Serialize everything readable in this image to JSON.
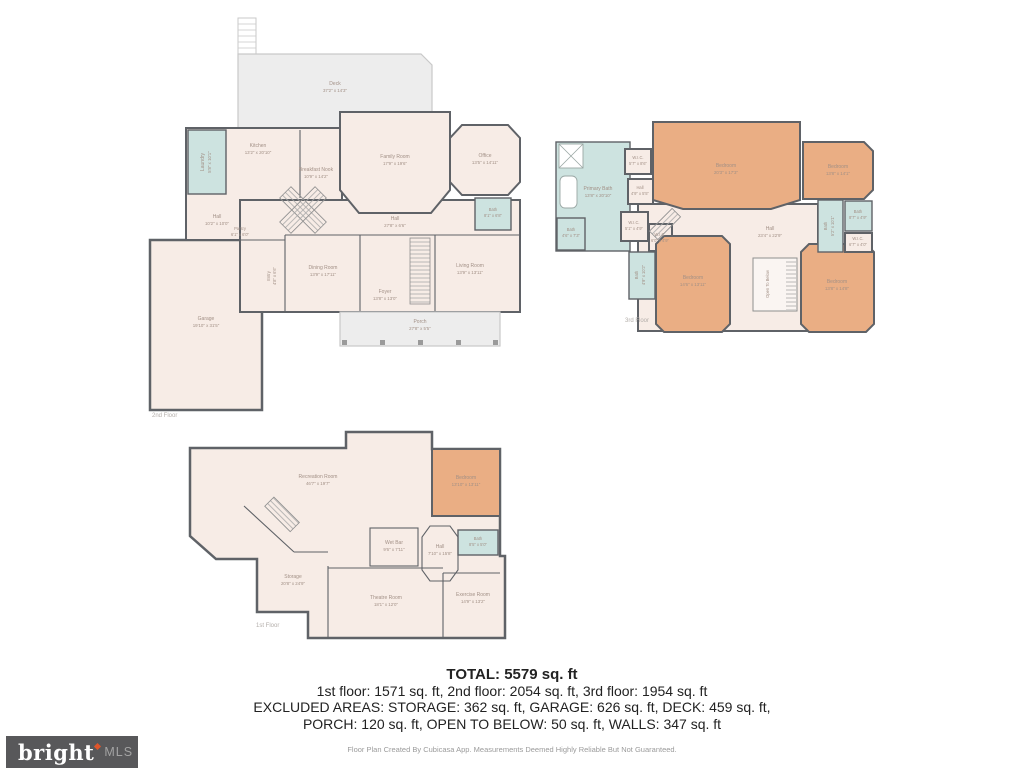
{
  "summary": {
    "total": "TOTAL: 5579 sq. ft",
    "floors_line": "1st floor: 1571 sq. ft, 2nd floor: 2054 sq. ft, 3rd floor: 1954 sq. ft",
    "excluded_line1": "EXCLUDED AREAS: STORAGE: 362 sq. ft, GARAGE: 626 sq. ft, DECK: 459 sq. ft,",
    "excluded_line2": "PORCH: 120 sq. ft, OPEN TO BELOW: 50 sq. ft, WALLS: 347 sq. ft"
  },
  "footer": {
    "credit": "Floor Plan Created By Cubicasa App. Measurements Deemed Highly Reliable But Not Guaranteed."
  },
  "branding": {
    "logo_text": "bright",
    "logo_suffix": "MLS",
    "accent_color": "#e0552a",
    "bar_color": "#58585a"
  },
  "colors": {
    "room_fill": "#f7ece6",
    "bedroom_fill": "#eaae84",
    "wet_room_fill": "#cde3e0",
    "outdoor_fill": "#ededed",
    "wall": "#5f6267"
  },
  "floors": {
    "second": {
      "label": "2nd Floor",
      "rooms": {
        "deck": {
          "name": "Deck",
          "dims": "37'2\" x 14'3\""
        },
        "laundry": {
          "name": "Laundry",
          "dims": "5'8\" x 10'1\""
        },
        "kitchen": {
          "name": "Kitchen",
          "dims": "13'2\" x 20'10\""
        },
        "breakfast": {
          "name": "Breakfast Nook",
          "dims": "10'9\" x 14'2\""
        },
        "family": {
          "name": "Family Room",
          "dims": "17'9\" x 19'6\""
        },
        "office": {
          "name": "Office",
          "dims": "13'5\" x 14'11\""
        },
        "bath": {
          "name": "Bath",
          "dims": "8'1\" x 6'8\""
        },
        "hall_left": {
          "name": "Hall",
          "dims": "10'2\" x 10'0\""
        },
        "pantry": {
          "name": "Pantry",
          "dims": "6'1\" x 6'0\""
        },
        "entry": {
          "name": "Entry",
          "dims": "4'8\" x 6'6\""
        },
        "hall": {
          "name": "Hall",
          "dims": "27'8\" x 6'6\""
        },
        "dining": {
          "name": "Dining Room",
          "dims": "13'9\" x 17'11\""
        },
        "foyer": {
          "name": "Foyer",
          "dims": "13'8\" x 13'0\""
        },
        "living": {
          "name": "Living Room",
          "dims": "13'9\" x 13'11\""
        },
        "porch": {
          "name": "Porch",
          "dims": "27'8\" x 5'5\""
        },
        "garage": {
          "name": "Garage",
          "dims": "19'10\" x 31'5\""
        }
      }
    },
    "third": {
      "label": "3rd Floor",
      "rooms": {
        "primary_bath": {
          "name": "Primary Bath",
          "dims": "13'8\" x 20'10\""
        },
        "wic_top": {
          "name": "W.I.C.",
          "dims": "5'7\" x 8'6\""
        },
        "hall_small": {
          "name": "Hall",
          "dims": "4'9\" x 5'5\""
        },
        "bath_left": {
          "name": "Bath",
          "dims": "4'6\" x 7'3\""
        },
        "wic_a": {
          "name": "W.I.C.",
          "dims": "5'1\" x 4'9\""
        },
        "wic_b": {
          "name": "W.I.C.",
          "dims": "6'0\" x 4'9\""
        },
        "bedroom_top": {
          "name": "Bedroom",
          "dims": "20'3\" x 17'3\""
        },
        "bedroom_right": {
          "name": "Bedroom",
          "dims": "13'8\" x 14'1\""
        },
        "bath_mid": {
          "name": "Bath",
          "dims": "5'2\" x 10'1\""
        },
        "bath_right": {
          "name": "Bath",
          "dims": "8'7\" x 4'9\""
        },
        "wic_right": {
          "name": "W.I.C.",
          "dims": "6'7\" x 4'0\""
        },
        "hall": {
          "name": "Hall",
          "dims": "23'4\" x 22'9\""
        },
        "open_below": {
          "name": "Open To Below"
        },
        "bedroom_bl": {
          "name": "Bedroom",
          "dims": "14'6\" x 13'11\""
        },
        "bath_bl": {
          "name": "Bath",
          "dims": "4'9\" x 10'2\""
        },
        "bedroom_br": {
          "name": "Bedroom",
          "dims": "13'8\" x 14'8\""
        }
      }
    },
    "first": {
      "label": "1st Floor",
      "rooms": {
        "recreation": {
          "name": "Recreation Room",
          "dims": "46'7\" x 19'7\""
        },
        "bedroom": {
          "name": "Bedroom",
          "dims": "13'10\" x 13'11\""
        },
        "wet_bar": {
          "name": "Wet Bar",
          "dims": "9'6\" x 7'11\""
        },
        "hall": {
          "name": "Hall",
          "dims": "7'10\" x 15'8\""
        },
        "bath": {
          "name": "Bath",
          "dims": "8'5\" x 5'0\""
        },
        "storage": {
          "name": "Storage",
          "dims": "20'8\" x 24'9\""
        },
        "theatre": {
          "name": "Theatre Room",
          "dims": "18'1\" x 12'0\""
        },
        "exercise": {
          "name": "Exercise Room",
          "dims": "14'9\" x 13'2\""
        }
      }
    }
  }
}
